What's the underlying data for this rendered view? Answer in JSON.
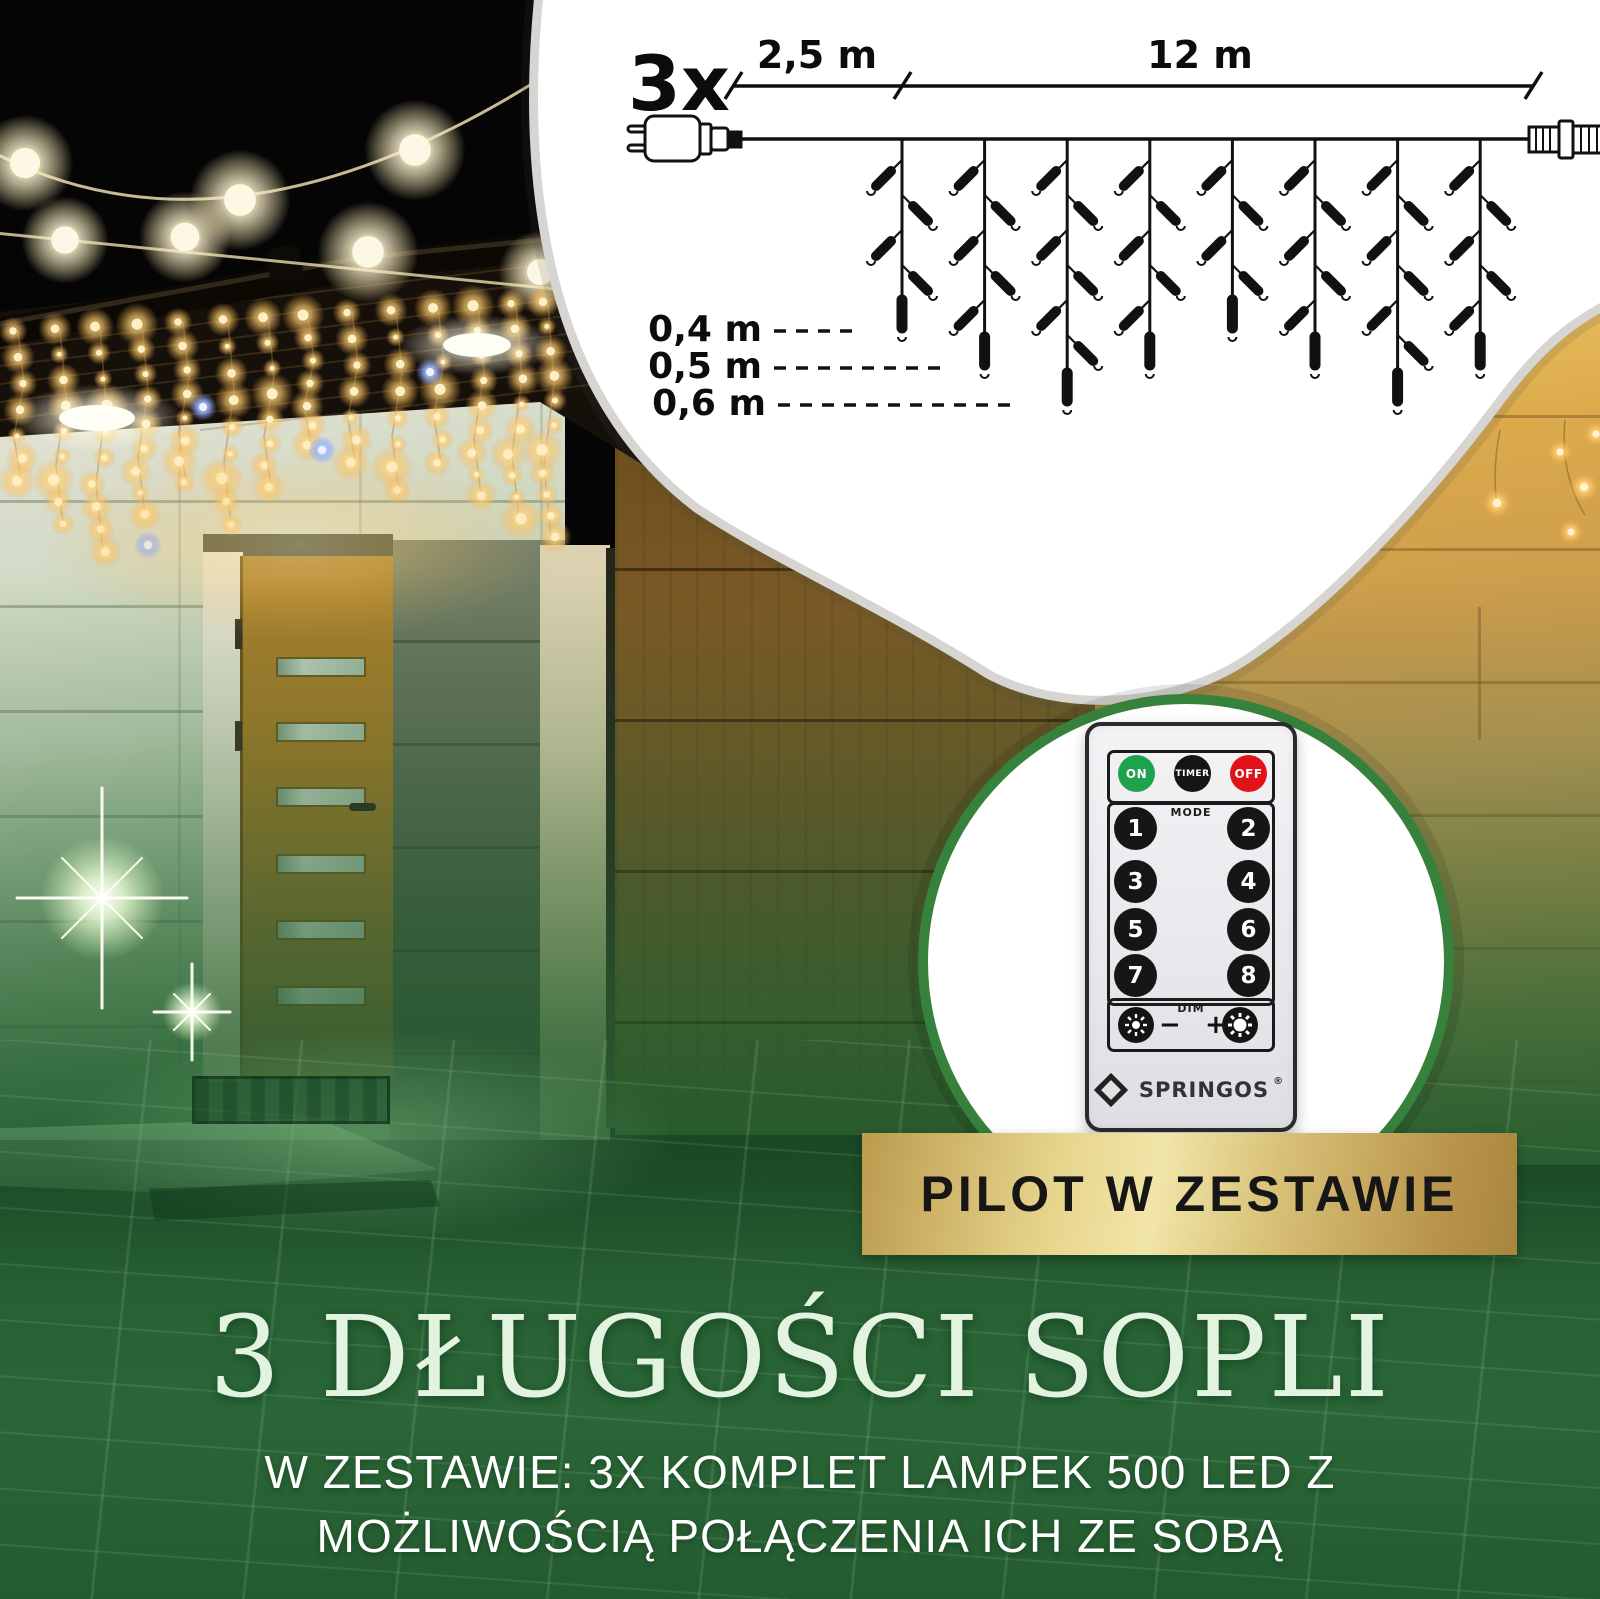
{
  "diagram": {
    "quantity_label": "3x",
    "lead_length_label": "2,5 m",
    "main_length_label": "12 m",
    "icicle_lengths": [
      {
        "label": "0,4 m",
        "meters": 0.4
      },
      {
        "label": "0,5 m",
        "meters": 0.5
      },
      {
        "label": "0,6 m",
        "meters": 0.6
      }
    ],
    "drop_pattern_m": [
      0.4,
      0.5,
      0.6,
      0.5,
      0.4,
      0.5,
      0.6,
      0.5
    ]
  },
  "remote": {
    "power_buttons": [
      {
        "label": "ON",
        "color": "#1fa24e"
      },
      {
        "label": "TIMER",
        "color": "#151515"
      },
      {
        "label": "OFF",
        "color": "#e21318"
      }
    ],
    "mode_label": "MODE",
    "mode_buttons": [
      "1",
      "2",
      "3",
      "4",
      "5",
      "6",
      "7",
      "8"
    ],
    "dim_label": "DIM",
    "dim_minus": "−",
    "dim_plus": "+",
    "brand": "SPRINGOS",
    "registered_mark": "®"
  },
  "banner": {
    "label": "PILOT W ZESTAWIE"
  },
  "heading": {
    "title": "3 DŁUGOŚCI SOPLI"
  },
  "subtitle": {
    "line1": "W ZESTAWIE: 3X KOMPLET LAMPEK 500 LED Z",
    "line2": "MOŻLIWOŚCIĄ POŁĄCZENIA ICH ZE SOBĄ"
  },
  "colors": {
    "accent_green": "#2c6b3a",
    "circle_ring_green": "#36813b",
    "gold_light": "#f1e5a8",
    "gold_dark": "#a8853e",
    "heading_mint": "#e2f3e0"
  }
}
